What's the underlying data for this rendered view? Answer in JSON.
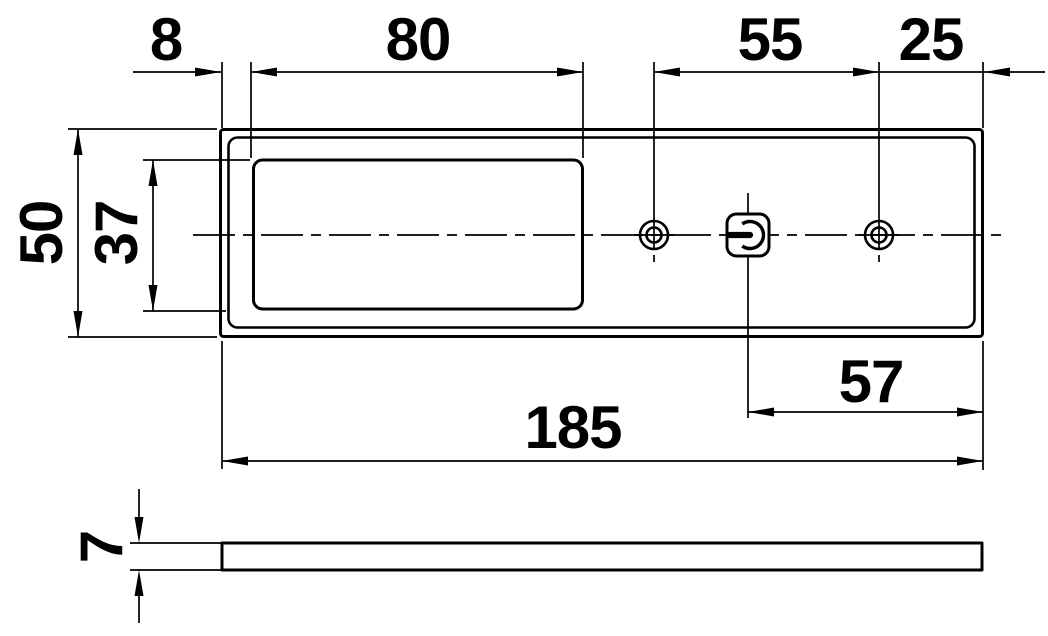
{
  "document": {
    "type": "dimensioned technical drawing",
    "subject": "flat rectangular light panel with recessed window, power switch and two mounting holes; front view and side profile"
  },
  "colors": {
    "line": "#000000",
    "background": "#ffffff",
    "text": "#000000"
  },
  "icons": {
    "power_switch": "power-icon",
    "mounting_hole": "crosshair-target-icon"
  },
  "views": {
    "front": {
      "dims": {
        "left_inset": "8",
        "window_width": "80",
        "hole_spacing": "55",
        "hole_to_edge": "25",
        "height": "50",
        "window_height": "37",
        "switch_to_edge": "57",
        "total_width": "185"
      }
    },
    "side": {
      "dims": {
        "thickness": "7"
      }
    }
  }
}
